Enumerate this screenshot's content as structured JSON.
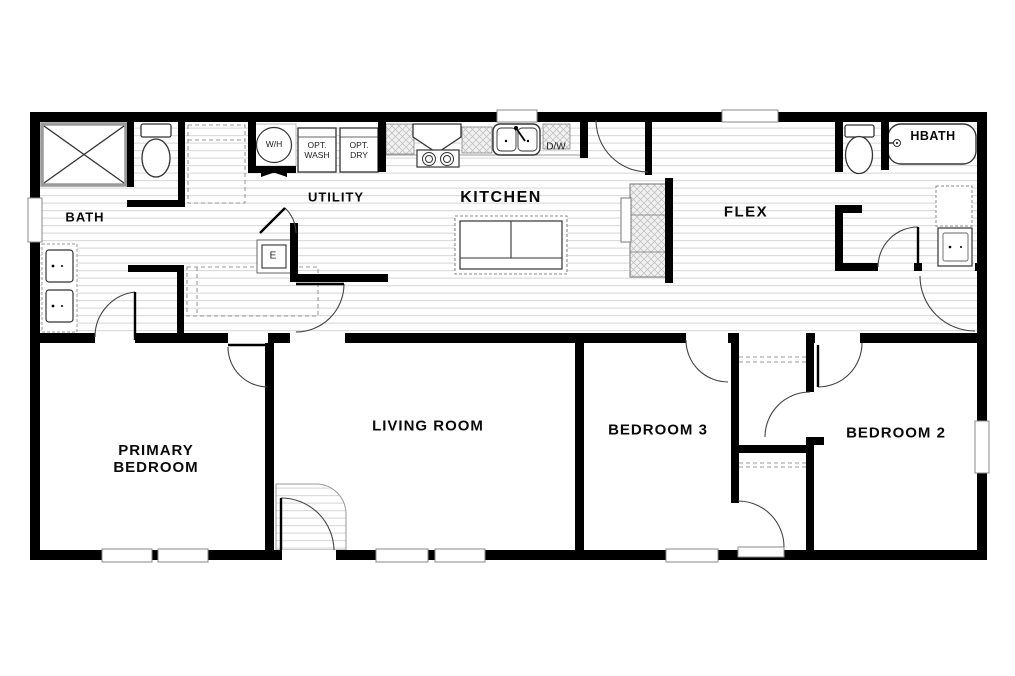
{
  "plan": {
    "title": "single-story-floor-plan",
    "rooms": {
      "bath": "BATH",
      "utility": "UTILITY",
      "kitchen": "KITCHEN",
      "flex": "FLEX",
      "hbath": "HBATH",
      "primary_bedroom": "PRIMARY BEDROOM",
      "living_room": "LIVING ROOM",
      "bedroom_3": "BEDROOM 3",
      "bedroom_2": "BEDROOM 2"
    },
    "fixtures": {
      "water_heater": "W/H",
      "optional_washer": "OPT. WASH",
      "optional_dryer": "OPT. DRY",
      "dishwasher": "D/W",
      "electrical_panel": "E"
    },
    "colors": {
      "wall": "#000000",
      "floor_stripe": "#dcdcdc",
      "counter_hatch": "#c4c4c4",
      "fixture_outline": "#333333"
    }
  }
}
